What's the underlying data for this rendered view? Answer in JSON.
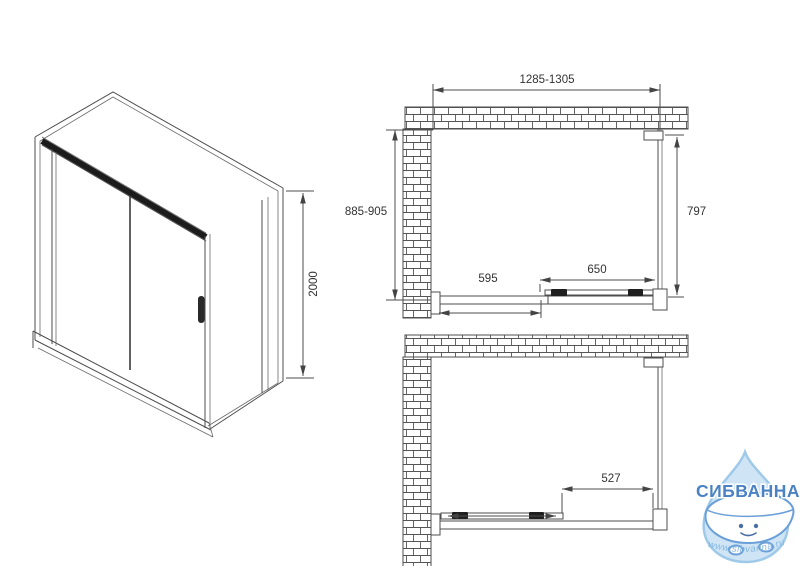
{
  "drawing": {
    "isometric": {
      "height_label": "2000"
    },
    "plan_closed": {
      "width_label": "1285-1305",
      "depth_label": "885-905",
      "side_panel_label": "797",
      "door_label": "650",
      "fixed_panel_label": "595"
    },
    "plan_open": {
      "opening_label": "527"
    }
  },
  "logo": {
    "brand": "СИБВАННА",
    "website": "www.sibvanna.ru"
  },
  "colors": {
    "line": "#4d4d4d",
    "dim_text": "#333333",
    "rail_dark": "#1c1c1c",
    "brand_blue": "#4a82c4",
    "logo_drop_fill": "#cfe5f5",
    "logo_drop_stroke": "#9ec9e9",
    "logo_tub_outline": "#6a9fd8",
    "logo_url_blue": "#85b7e2"
  }
}
